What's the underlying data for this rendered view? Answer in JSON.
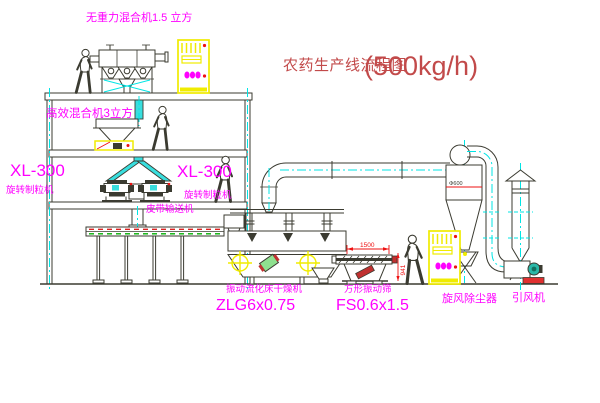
{
  "title": {
    "text": "农药生产线流程图",
    "capacity": "(500kg/h)"
  },
  "labels": {
    "gravity_mixer": "无重力混合机1.5 立方",
    "high_eff_mixer": "高效混合机3立方",
    "granulator_left_model": "XL-300",
    "granulator_left_name": "旋转制粒机",
    "granulator_mid_model": "XL-300",
    "granulator_mid_name": "旋转制粒机",
    "belt_conveyor": "皮带输送机",
    "dryer_name": "振动流化床干燥机",
    "dryer_model": "ZLG6x0.75",
    "screen_name": "方形振动筛",
    "screen_model": "FS0.6x1.5",
    "cyclone": "旋风除尘器",
    "fan": "引风机"
  },
  "dimensions": {
    "screen_length": "1500",
    "screen_height": "941",
    "cyclone_diameter": "Φ600"
  },
  "colors": {
    "line": "#3b3b31",
    "magenta": "#ff00ff",
    "red": "#ee1111",
    "title_red": "#c24a4a",
    "cyan": "#00e5e5",
    "cyan_fill": "#39dede",
    "yellow": "#f0ec00",
    "green": "#00b000"
  }
}
